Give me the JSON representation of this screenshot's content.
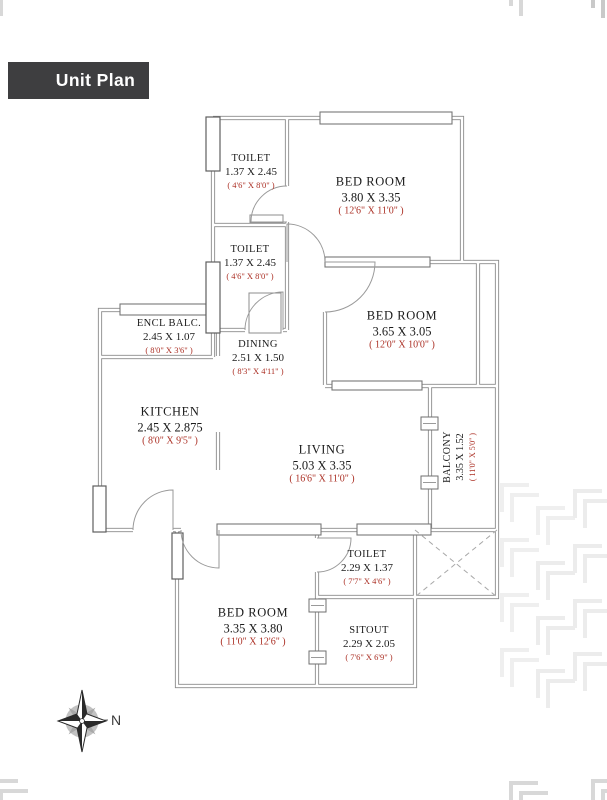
{
  "title": "Unit Plan",
  "compass": {
    "label": "N"
  },
  "colors": {
    "title_bg": "#3e3e40",
    "dimension_red": "#ab2f24",
    "wall_gray": "#8a8a8a",
    "watermark_gray": "#ededed"
  },
  "rooms": [
    {
      "id": "toilet-1",
      "name": "TOILET",
      "metric": "1.37 X 2.45",
      "imperial": "( 4'6\" X 8'0\" )"
    },
    {
      "id": "bedroom-1",
      "name": "BED ROOM",
      "metric": "3.80 X 3.35",
      "imperial": "( 12'6\" X 11'0\" )"
    },
    {
      "id": "toilet-2",
      "name": "TOILET",
      "metric": "1.37 X 2.45",
      "imperial": "( 4'6\" X 8'0\" )"
    },
    {
      "id": "bedroom-2",
      "name": "BED ROOM",
      "metric": "3.65 X 3.05",
      "imperial": "( 12'0\" X 10'0\" )"
    },
    {
      "id": "encl-balc",
      "name": "ENCL BALC.",
      "metric": "2.45 X 1.07",
      "imperial": "( 8'0\" X 3'6\" )"
    },
    {
      "id": "dining",
      "name": "DINING",
      "metric": "2.51 X 1.50",
      "imperial": "( 8'3\" X 4'11\" )"
    },
    {
      "id": "kitchen",
      "name": "KITCHEN",
      "metric": "2.45 X 2.875",
      "imperial": "( 8'0\" X 9'5\" )"
    },
    {
      "id": "living",
      "name": "LIVING",
      "metric": "5.03 X 3.35",
      "imperial": "( 16'6\" X 11'0\" )"
    },
    {
      "id": "balcony",
      "name": "BALCONY",
      "metric": "3.35 X 1.52",
      "imperial": "( 11'0\" X 5'0\" )"
    },
    {
      "id": "toilet-3",
      "name": "TOILET",
      "metric": "2.29 X 1.37",
      "imperial": "( 7'7\" X 4'6\" )"
    },
    {
      "id": "bedroom-3",
      "name": "BED ROOM",
      "metric": "3.35 X 3.80",
      "imperial": "( 11'0\" X 12'6\" )"
    },
    {
      "id": "sitout",
      "name": "SITOUT",
      "metric": "2.29 X 2.05",
      "imperial": "( 7'6\" X 6'9\" )"
    }
  ]
}
